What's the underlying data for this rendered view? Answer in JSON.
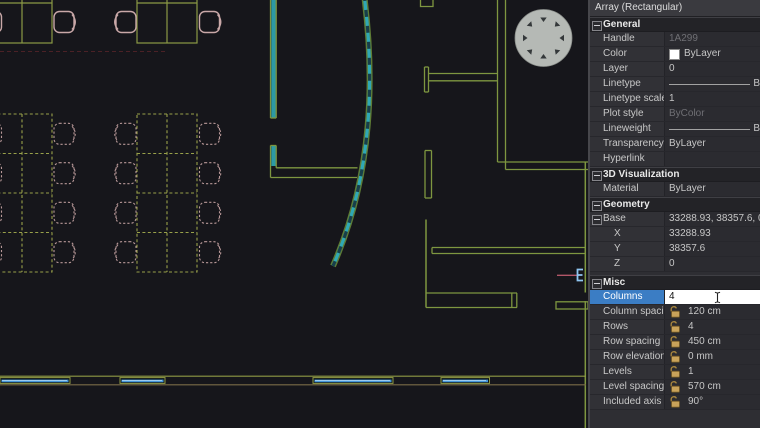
{
  "panel": {
    "title": "Array (Rectangular)",
    "sections": [
      {
        "name": "General",
        "rows": [
          {
            "label": "Handle",
            "value": "1A299"
          },
          {
            "label": "Color",
            "value": "ByLayer"
          },
          {
            "label": "Layer",
            "value": "0"
          },
          {
            "label": "Linetype",
            "value": "B"
          },
          {
            "label": "Linetype scale",
            "value": "1"
          },
          {
            "label": "Plot style",
            "value": "ByColor"
          },
          {
            "label": "Lineweight",
            "value": "B"
          },
          {
            "label": "Transparency",
            "value": "ByLayer"
          },
          {
            "label": "Hyperlink",
            "value": ""
          }
        ]
      },
      {
        "name": "3D Visualization",
        "rows": [
          {
            "label": "Material",
            "value": "ByLayer"
          }
        ]
      },
      {
        "name": "Geometry",
        "rows": [
          {
            "label": "Base",
            "value": "33288.93, 38357.6, 0"
          },
          {
            "label": "X",
            "value": "33288.93"
          },
          {
            "label": "Y",
            "value": "38357.6"
          },
          {
            "label": "Z",
            "value": "0"
          }
        ]
      },
      {
        "name": "Misc",
        "rows": [
          {
            "label": "Columns",
            "value": "4"
          },
          {
            "label": "Column spacing",
            "value": "120 cm"
          },
          {
            "label": "Rows",
            "value": "4"
          },
          {
            "label": "Row spacing",
            "value": "450 cm"
          },
          {
            "label": "Row elevation in",
            "value": "0 mm"
          },
          {
            "label": "Levels",
            "value": "1"
          },
          {
            "label": "Level spacing",
            "value": "570 cm"
          },
          {
            "label": "Included axis ang",
            "value": "90°"
          }
        ]
      }
    ]
  },
  "canvas": {
    "objects": [
      "office-desks-with-chairs",
      "rectangular-array-dashed-preview",
      "curved-glass-wall",
      "interior-walls",
      "round-structural-column",
      "window-wall",
      "selected-line-with-grip"
    ],
    "colors": {
      "canvas_bg": "#16161b",
      "wall_olive": "#7e9640",
      "glass_teal": "#2fa8b5",
      "window_blue": "#4596d8",
      "chair_pink": "#c9a8a8",
      "column_gray": "#b5b9b5",
      "selection_blue": "#3b7dc4",
      "lock_gold": "#c9a35a",
      "grip_blue": "#8fc6f2"
    }
  }
}
